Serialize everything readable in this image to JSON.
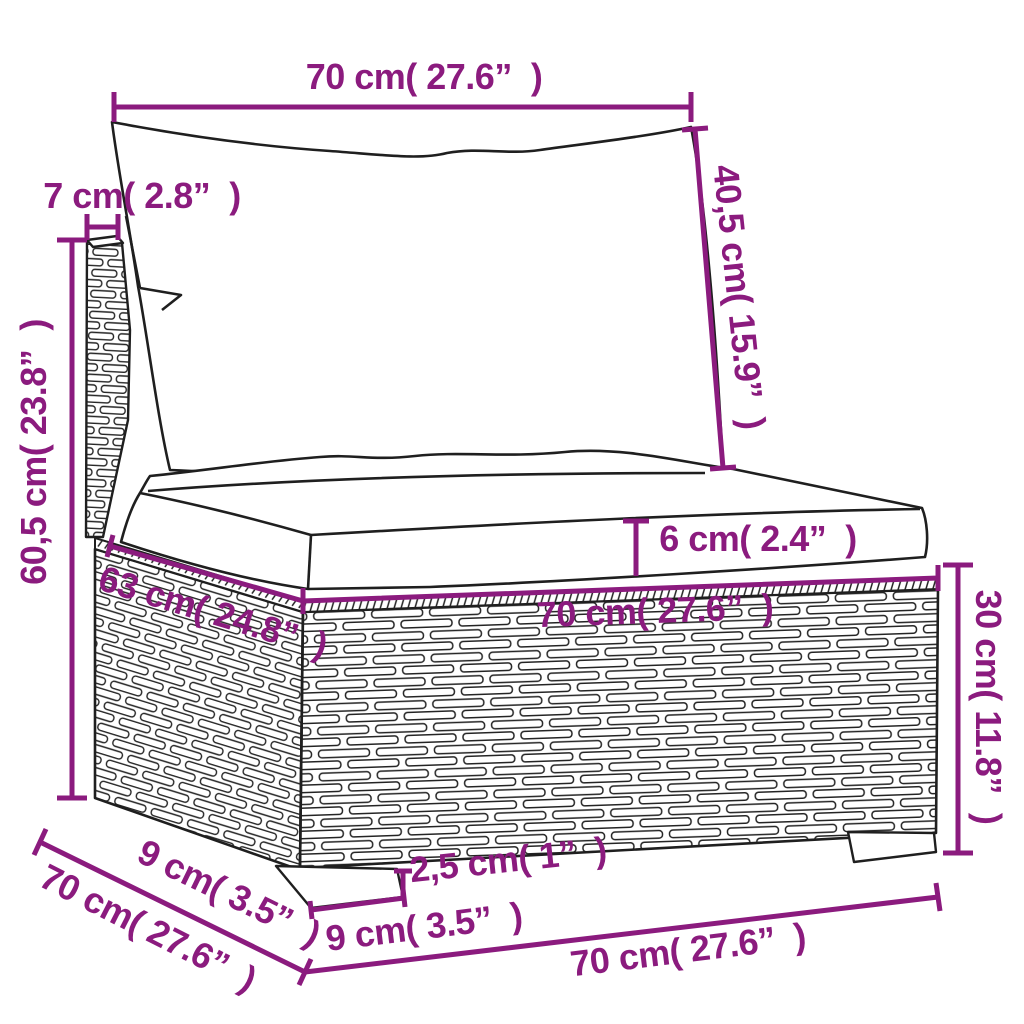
{
  "diagram": {
    "type": "product-dimension-diagram",
    "subject": "rattan garden sofa section with back and seat cushions",
    "colors": {
      "dimension_accent": "#8B1B7E",
      "line_art": "#1f1f1f",
      "background": "#ffffff"
    },
    "labels": {
      "back_cushion_width": "70 cm( 27.6”  )",
      "arm_thickness": "7 cm( 2.8”  )",
      "back_cushion_height": "40,5 cm( 15.9”  )",
      "total_height": "60,5 cm( 23.8”  )",
      "seat_cushion_thickness": "6 cm( 2.4”  )",
      "seat_top_depth": "63 cm( 24.8”  )",
      "seat_width": "70 cm( 27.6”  )",
      "base_height": "30 cm( 11.8”  )",
      "foot_depth": "9 cm( 3.5”  )",
      "base_depth": "70 cm( 27.6”  )",
      "foot_height": "2,5 cm( 1”  )",
      "foot_width": "9 cm( 3.5”  )",
      "base_width": "70 cm( 27.6”  )"
    }
  }
}
